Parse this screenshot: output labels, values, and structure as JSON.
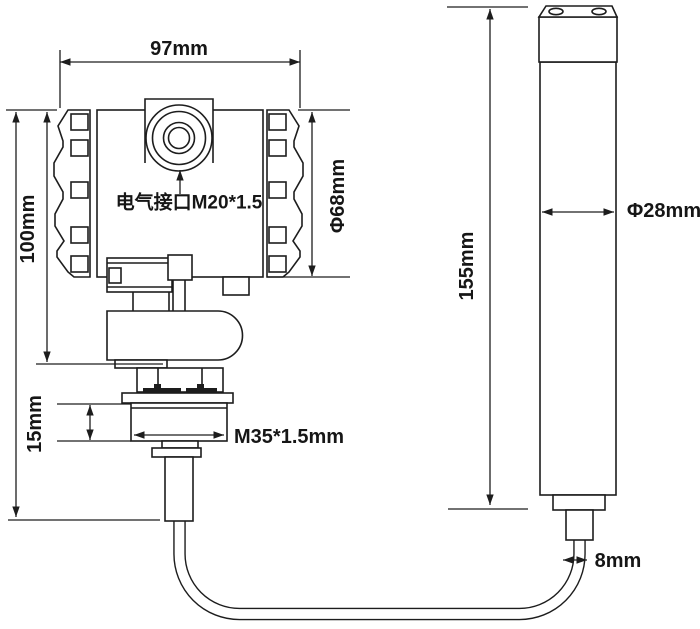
{
  "figure": {
    "type": "technical-dimension-drawing",
    "background": "#ffffff",
    "line_color": "#1d1d1d",
    "transmitter": {
      "width_label": "97mm",
      "height_label": "100mm",
      "housing_diameter_label": "Φ68mm",
      "conduit_label": "电气接口M20*1.5",
      "thread_length_label": "15mm",
      "thread_label": "M35*1.5mm"
    },
    "probe": {
      "length_label": "155mm",
      "diameter_label": "Φ28mm",
      "cable_diameter_label": "8mm"
    }
  }
}
